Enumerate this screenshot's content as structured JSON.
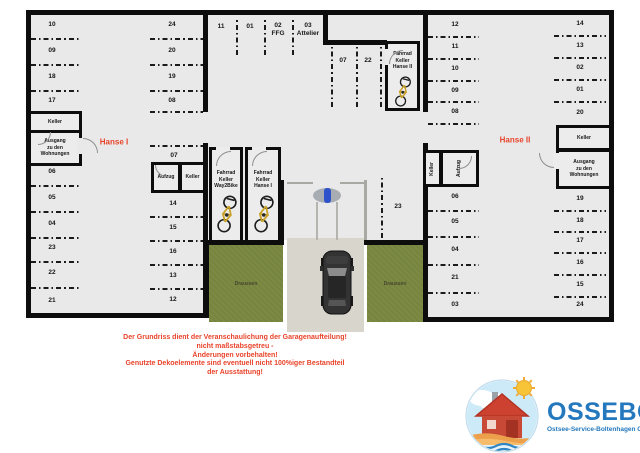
{
  "colors": {
    "accent_red": "#e8432a",
    "logo_blue": "#2478bd",
    "grass_green": "#7c8b43",
    "wall_black": "#0d0d0d"
  },
  "buildings": {
    "hanse1": "Hanse I",
    "hanse2": "Hanse II"
  },
  "spaces": {
    "left_outer_top": [
      "10",
      "09",
      "18",
      "17"
    ],
    "left_outer_bottom": [
      "06",
      "05",
      "04",
      "23",
      "22",
      "21"
    ],
    "left_inner_top": [
      "24",
      "20",
      "19",
      "08"
    ],
    "left_inner_mid": "07",
    "left_inner_bottom": [
      "14",
      "15",
      "16",
      "13",
      "12"
    ],
    "top_strip": [
      "11",
      "01",
      "02\nFFG",
      "03\nAttelier"
    ],
    "mid_vertical": [
      "07",
      "22"
    ],
    "mid_right": "23",
    "right_outer_top": [
      "12",
      "11",
      "10",
      "09",
      "08"
    ],
    "right_outer_bottom": [
      "06",
      "05",
      "04",
      "21",
      "03"
    ],
    "right_inner_top": [
      "14",
      "13",
      "02",
      "01",
      "20"
    ],
    "right_inner_bottom": [
      "19",
      "18",
      "17",
      "16",
      "15",
      "24"
    ]
  },
  "rooms": {
    "keller": "Keller",
    "aufzug": "Aufzug",
    "ausgang": "Ausgang\nzu den\nWohnungen",
    "fahrrad_way2bike": "Fahrrad\nKeller\nWay2Bike",
    "fahrrad_hanse1": "Fahrrad\nKeller\nHanse I",
    "fahrrad_hanse2": "Fahrrad\nKeller\nHanse II"
  },
  "outside": {
    "draussen": "Draussen"
  },
  "disclaimer": {
    "lines": [
      "Der Grundriss dient der Veranschaulichung der Garagenaufteilung!",
      "nicht maßstabsgetreu -",
      "Änderungen vorbehalten!",
      "Genutzte Dekoelemente sind eventuell nicht 100%iger Bestandteil",
      "der Ausstattung!"
    ]
  },
  "logo": {
    "name": "OSSEBO",
    "subtitle": "Ostsee-Service-Boltenhagen GmbH"
  }
}
